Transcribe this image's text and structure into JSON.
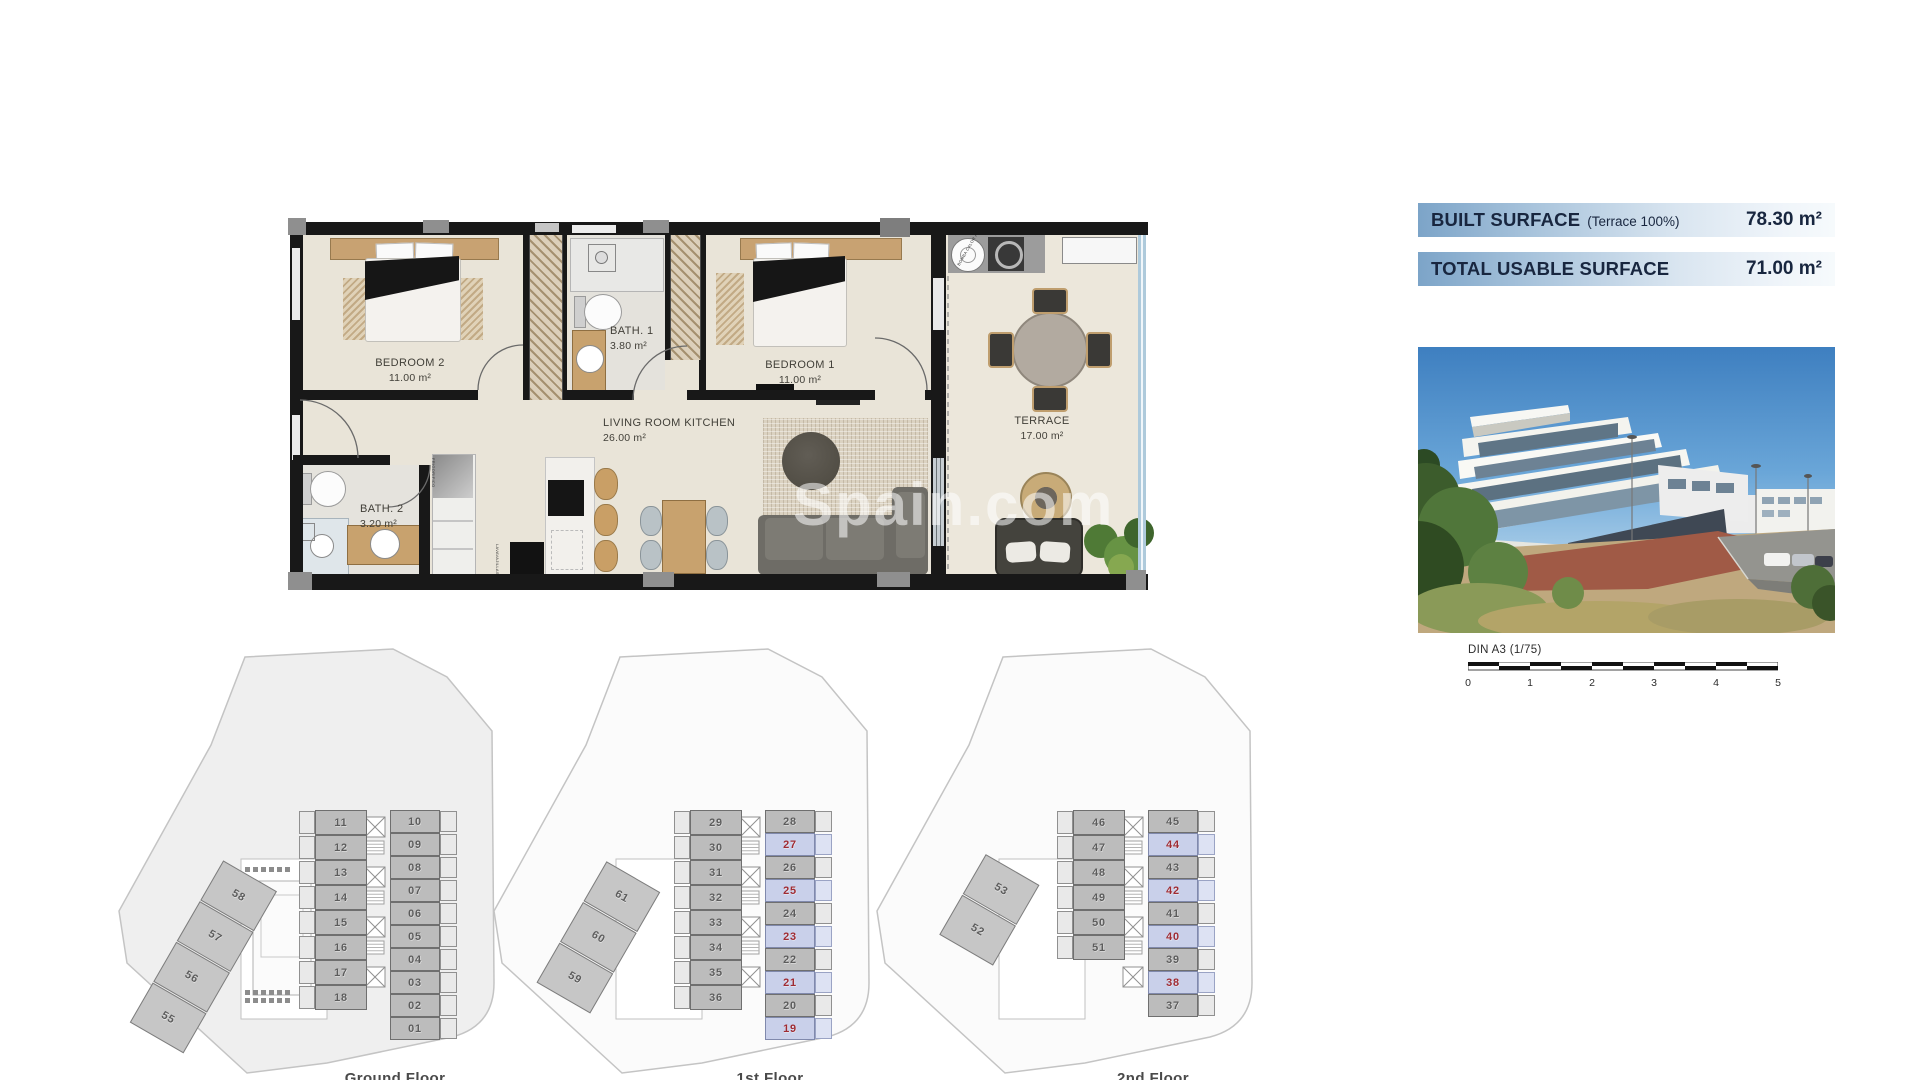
{
  "watermark": "Spain.com",
  "surface_info": {
    "rows": [
      {
        "label": "BUILT SURFACE",
        "note": "(Terrace 100%)",
        "value": "78.30 m²"
      },
      {
        "label": "TOTAL USABLE SURFACE",
        "note": "",
        "value": "71.00 m²"
      }
    ]
  },
  "floor_plan": {
    "rooms": {
      "bedroom2": {
        "name": "BEDROOM 2",
        "area": "11.00 m²"
      },
      "bath1": {
        "name": "BATH. 1",
        "area": "3.80 m²"
      },
      "bedroom1": {
        "name": "BEDROOM 1",
        "area": "11.00 m²"
      },
      "living": {
        "name": "LIVING ROOM KITCHEN",
        "area": "26.00 m²"
      },
      "bath2": {
        "name": "BATH. 2",
        "area": "3.20 m²"
      },
      "terrace": {
        "name": "TERRACE",
        "area": "17.00 m²"
      }
    },
    "appliance_labels": {
      "fridge": "FRIGORIFICO",
      "dishwasher": "LAVAVAJILLAS",
      "heat_pump": "BOMBA CALOR ACS"
    }
  },
  "scale_bar": {
    "label": "DIN A3 (1/75)",
    "ticks": [
      "0",
      "1",
      "2",
      "3",
      "4",
      "5"
    ]
  },
  "floors": [
    {
      "caption": "Ground Floor",
      "left_units": [
        {
          "num": "11"
        },
        {
          "num": "12"
        },
        {
          "num": "13"
        },
        {
          "num": "14"
        },
        {
          "num": "15"
        },
        {
          "num": "16"
        },
        {
          "num": "17"
        },
        {
          "num": "18"
        }
      ],
      "right_units": [
        {
          "num": "10"
        },
        {
          "num": "09"
        },
        {
          "num": "08"
        },
        {
          "num": "07"
        },
        {
          "num": "06"
        },
        {
          "num": "05"
        },
        {
          "num": "04"
        },
        {
          "num": "03"
        },
        {
          "num": "02"
        },
        {
          "num": "01"
        }
      ],
      "diagonal_units": [
        {
          "num": "58"
        },
        {
          "num": "57"
        },
        {
          "num": "56"
        },
        {
          "num": "55"
        }
      ]
    },
    {
      "caption": "1st Floor",
      "left_units": [
        {
          "num": "29"
        },
        {
          "num": "30"
        },
        {
          "num": "31"
        },
        {
          "num": "32"
        },
        {
          "num": "33"
        },
        {
          "num": "34"
        },
        {
          "num": "35"
        },
        {
          "num": "36"
        }
      ],
      "right_units": [
        {
          "num": "28"
        },
        {
          "num": "27",
          "highlight": true
        },
        {
          "num": "26"
        },
        {
          "num": "25",
          "highlight": true
        },
        {
          "num": "24"
        },
        {
          "num": "23",
          "highlight": true
        },
        {
          "num": "22"
        },
        {
          "num": "21",
          "highlight": true
        },
        {
          "num": "20"
        },
        {
          "num": "19",
          "highlight": true
        }
      ],
      "diagonal_units": [
        {
          "num": "61"
        },
        {
          "num": "60"
        },
        {
          "num": "59"
        }
      ]
    },
    {
      "caption": "2nd Floor",
      "left_units": [
        {
          "num": "46"
        },
        {
          "num": "47"
        },
        {
          "num": "48"
        },
        {
          "num": "49"
        },
        {
          "num": "50"
        },
        {
          "num": "51"
        }
      ],
      "right_units": [
        {
          "num": "45"
        },
        {
          "num": "44",
          "highlight": true
        },
        {
          "num": "43"
        },
        {
          "num": "42",
          "highlight": true
        },
        {
          "num": "41"
        },
        {
          "num": "40",
          "highlight": true
        },
        {
          "num": "39"
        },
        {
          "num": "38",
          "highlight": true
        },
        {
          "num": "37"
        }
      ],
      "diagonal_units": [
        {
          "num": "53"
        },
        {
          "num": "52"
        }
      ]
    }
  ],
  "colors": {
    "highlight_fill": "#c9d0ea",
    "highlight_number": "#9e2b33",
    "unit_fill": "#bcbcbc",
    "unit_number": "#5c5c5c",
    "info_gradient_left": "#7ca4c8",
    "info_text": "#18263f",
    "wall": "#181818",
    "floor": "#e9e4d8"
  }
}
